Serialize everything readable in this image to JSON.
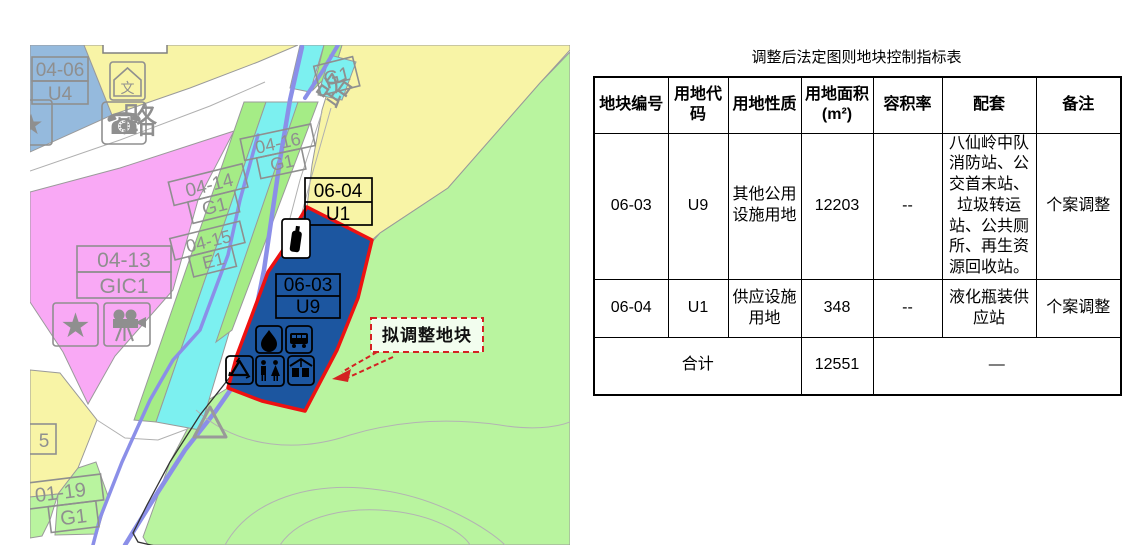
{
  "table": {
    "title": "调整后法定图则地块控制指标表",
    "headers": [
      "地块编号",
      "用地代码",
      "用地性质",
      "用地面积(m²)",
      "容积率",
      "配套",
      "备注"
    ],
    "rows": [
      {
        "plot": "06-03",
        "code": "U9",
        "nature": "其他公用设施用地",
        "area": "12203",
        "far": "--",
        "facilities": "八仙岭中队消防站、公交首末站、垃圾转运站、公共厕所、再生资源回收站。",
        "note": "个案调整"
      },
      {
        "plot": "06-04",
        "code": "U1",
        "nature": "供应设施用地",
        "area": "348",
        "far": "--",
        "facilities": "液化瓶装供应站",
        "note": "个案调整"
      }
    ],
    "total": {
      "label": "合计",
      "area": "12551",
      "dash": "—"
    }
  },
  "map": {
    "annotation": "拟调整地块",
    "road_label": "路",
    "labels": {
      "z0406": {
        "code": "04-06",
        "use": "U4"
      },
      "z0413": {
        "code": "04-13",
        "use": "GIC1"
      },
      "z0414": {
        "code": "04-14",
        "use": "G1"
      },
      "z0415": {
        "code": "04-15",
        "use": "E1"
      },
      "z0416": {
        "code": "04-16",
        "use": "G1"
      },
      "z0119": {
        "code": "01-19",
        "use": "G1"
      },
      "z0603": {
        "code": "06-03",
        "use": "U9"
      },
      "z0604": {
        "code": "06-04",
        "use": "U1"
      },
      "zG1": {
        "use": "G1"
      },
      "z5": {
        "code": "5"
      }
    },
    "icons": [
      "telephone",
      "culture-house",
      "star",
      "film-projector",
      "gas-bottle",
      "fire-station",
      "bus-terminal",
      "recycling",
      "public-toilet",
      "waste-transfer"
    ],
    "colors": {
      "plot_fill": "#1c56a0",
      "plot_border": "#ee1111",
      "pink": "#f9a9f5",
      "yellow": "#f8f4a6",
      "green": "#b9f49f",
      "strip_green": "#a5ec86",
      "cyan": "#7cf0f0",
      "blue_zone": "#95badd",
      "river": "#8b8fe8",
      "label_gray": "#8f8f8f",
      "annotation_red": "#d42222"
    }
  }
}
